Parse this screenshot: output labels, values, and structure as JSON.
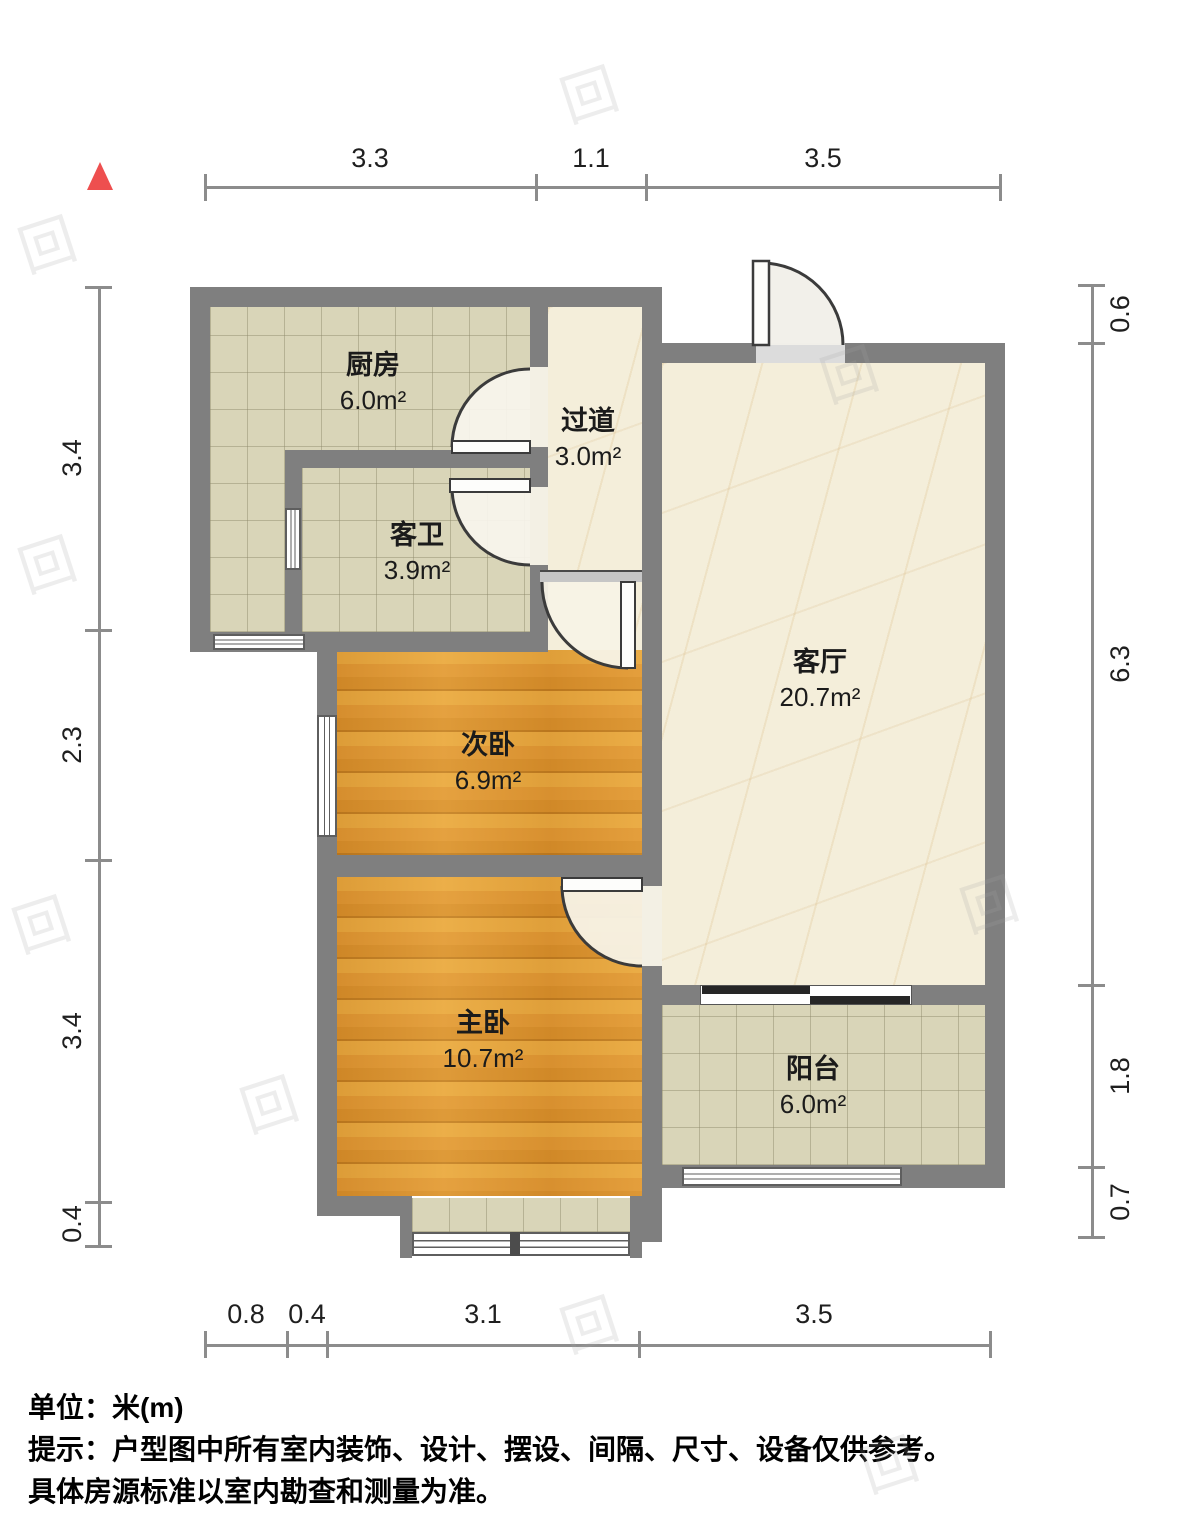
{
  "title": "户型图",
  "rooms": [
    {
      "id": "kitchen",
      "name": "厨房",
      "area": "6.0m²"
    },
    {
      "id": "hallway",
      "name": "过道",
      "area": "3.0m²"
    },
    {
      "id": "bathroom",
      "name": "客卫",
      "area": "3.9m²"
    },
    {
      "id": "bedroom2",
      "name": "次卧",
      "area": "6.9m²"
    },
    {
      "id": "living",
      "name": "客厅",
      "area": "20.7m²"
    },
    {
      "id": "bedroom1",
      "name": "主卧",
      "area": "10.7m²"
    },
    {
      "id": "balcony",
      "name": "阳台",
      "area": "6.0m²"
    }
  ],
  "dimensions": {
    "top": [
      "3.3",
      "1.1",
      "3.5"
    ],
    "bottom": [
      "0.8",
      "0.4",
      "3.1",
      "3.5"
    ],
    "left": [
      "3.4",
      "2.3",
      "3.4",
      "0.4"
    ],
    "right": [
      "0.6",
      "6.3",
      "1.8",
      "0.7"
    ]
  },
  "footer": {
    "unit_line": "单位：米(m)",
    "note_line1": "提示：户型图中所有室内装饰、设计、摆设、间隔、尺寸、设备仅供参考。",
    "note_line2": "具体房源标准以室内勘查和测量为准。"
  },
  "watermark": {
    "glyph": "回"
  },
  "colors": {
    "wall": "#7f7f7f",
    "tile_floor": "#d9d5b8",
    "marble_floor": "#f4eeda",
    "wood_floor": "#e09a35",
    "north_marker": "#ee4f4f",
    "dimension_line": "#8c8c8c",
    "text": "#1b1b1b"
  }
}
